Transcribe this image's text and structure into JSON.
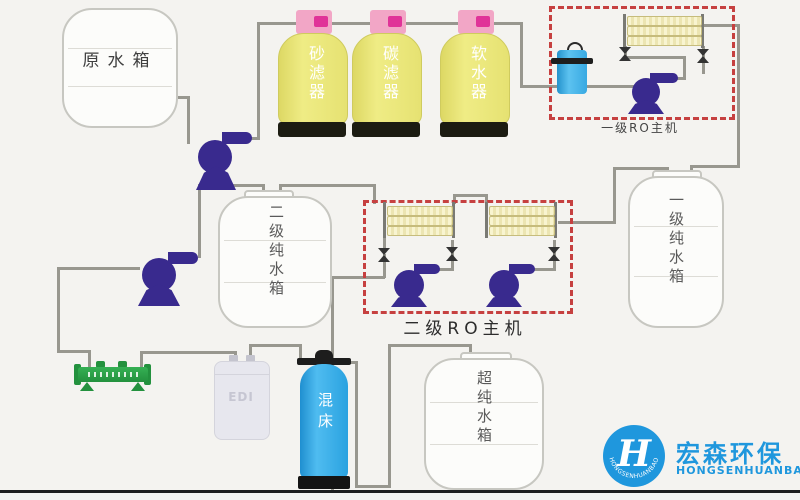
{
  "diagram": {
    "tanks": {
      "raw": "原水箱",
      "stage2_pure": "二级纯水箱",
      "stage1_pure": "一级纯水箱",
      "ultrapure": "超纯水箱"
    },
    "filters": {
      "sand": "砂滤器",
      "carbon": "碳滤器",
      "softener": "软水器"
    },
    "ro_units": {
      "stage1": "一级RO主机",
      "stage2": "二级RO主机"
    },
    "polish": {
      "edi": "EDI",
      "mixed_bed": "混床"
    },
    "logo": {
      "cn": "宏森环保",
      "en": "HONGSENHUANBAO",
      "ring_text": "HONGSENHUANBAO",
      "monogram": "H"
    },
    "colors": {
      "pipe_gray": "#98978f",
      "vessel_yellow": "#eae673",
      "vessel_cap_pink": "#f2a6c6",
      "cap_accent_magenta": "#e03398",
      "vessel_base_black": "#1c1c12",
      "pump_blue": "#392a8e",
      "membrane_yellow": "#f8f4d0",
      "dashed_box_red": "#c64040",
      "cartridge_filter_blue": "#45b3e8",
      "mixed_bed_blue": "#2ba2e2",
      "uv_green": "#2aa147",
      "edi_gray": "#e7e7ee",
      "logo_blue": "#1f97dd"
    }
  }
}
